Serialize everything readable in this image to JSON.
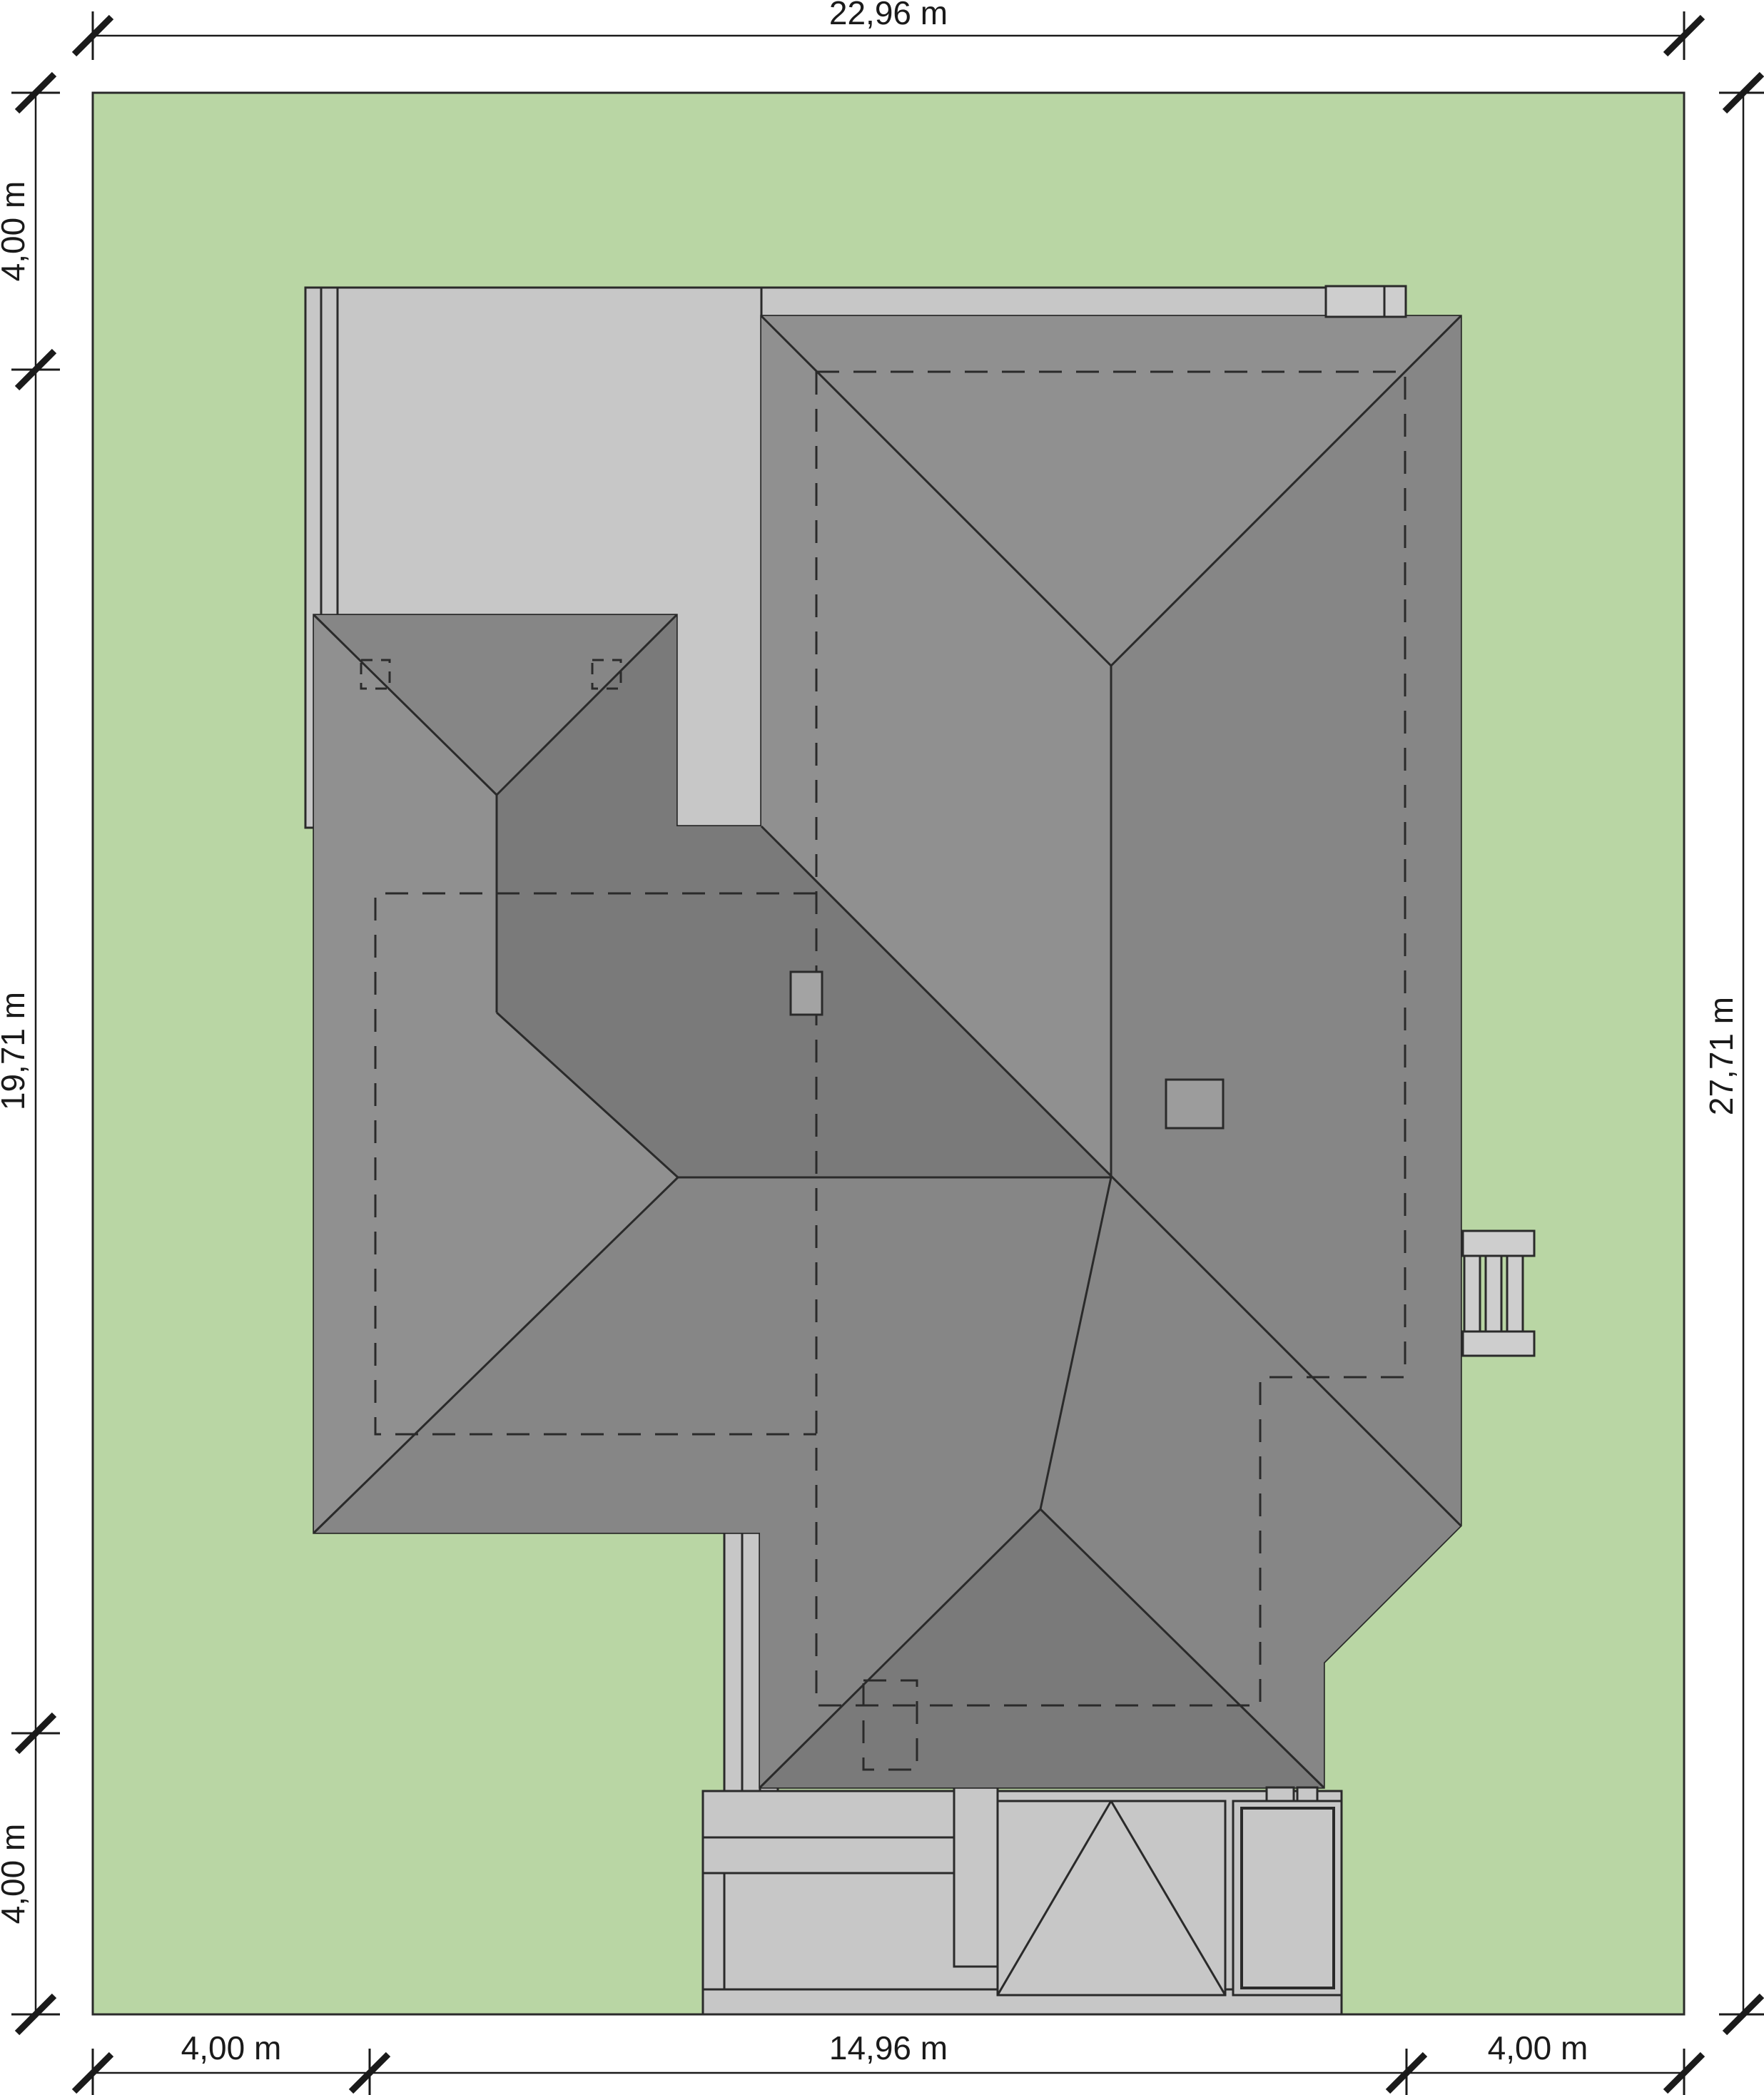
{
  "drawing": {
    "kind": "house site plan with roof view",
    "plot_width_label": "22,96 m",
    "plot_height_label": "27,71 m"
  },
  "dimensions": {
    "top": "22,96 m",
    "right": "27,71 m",
    "left_top": "4,00 m",
    "left_middle": "19,71 m",
    "left_bottom": "4,00 m",
    "bottom_left": "4,00 m",
    "bottom_center": "14,96 m",
    "bottom_right": "4,00 m"
  },
  "colors": {
    "background": "#ffffff",
    "lawn": "#b9d6a4",
    "paving": "#c7c7c7",
    "paving_light": "#cecece",
    "roof_light": "#909090",
    "roof_base": "#868686",
    "roof_dark": "#7a7a7a",
    "chimney": "#a3a3a3",
    "chimney_small": "#9c9c9c",
    "line": "#2a2a2a",
    "dim_line": "#1a1a1a"
  }
}
